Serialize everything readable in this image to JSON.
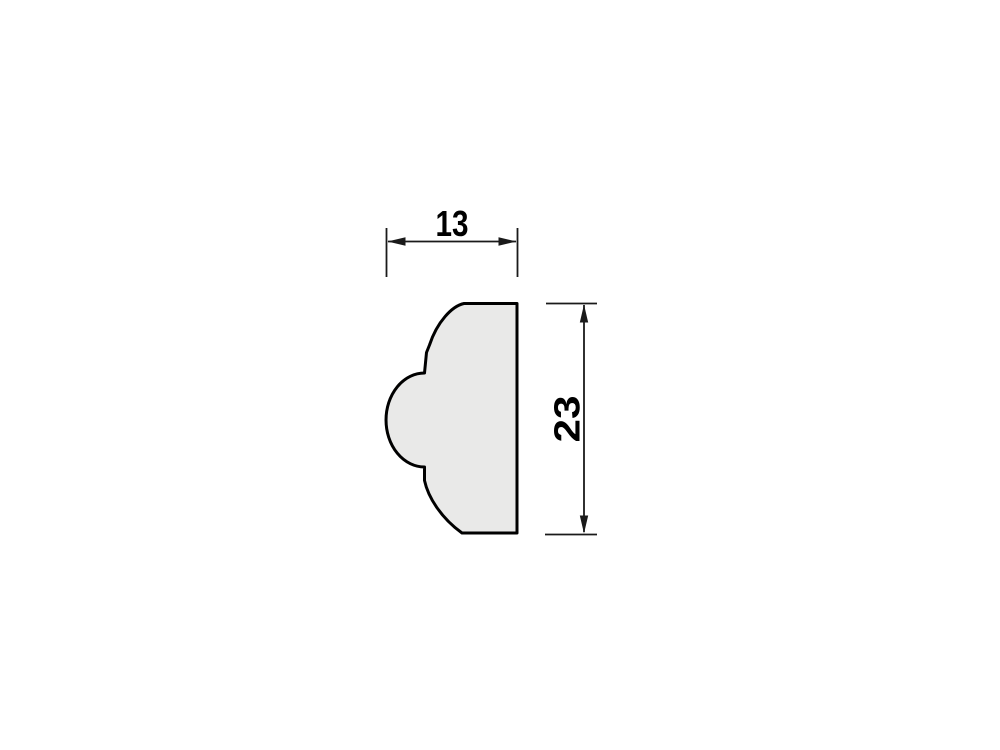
{
  "diagram": {
    "type": "technical-drawing",
    "subject": "molding-profile-cross-section",
    "width_dimension": {
      "label": "13",
      "value": 13
    },
    "height_dimension": {
      "label": "23",
      "value": 23
    },
    "colors": {
      "background": "#ffffff",
      "profile_fill": "#e9e9e8",
      "profile_outline": "#000000",
      "dimension_lines": "#1a1a1a",
      "dimension_text": "#000000"
    }
  }
}
